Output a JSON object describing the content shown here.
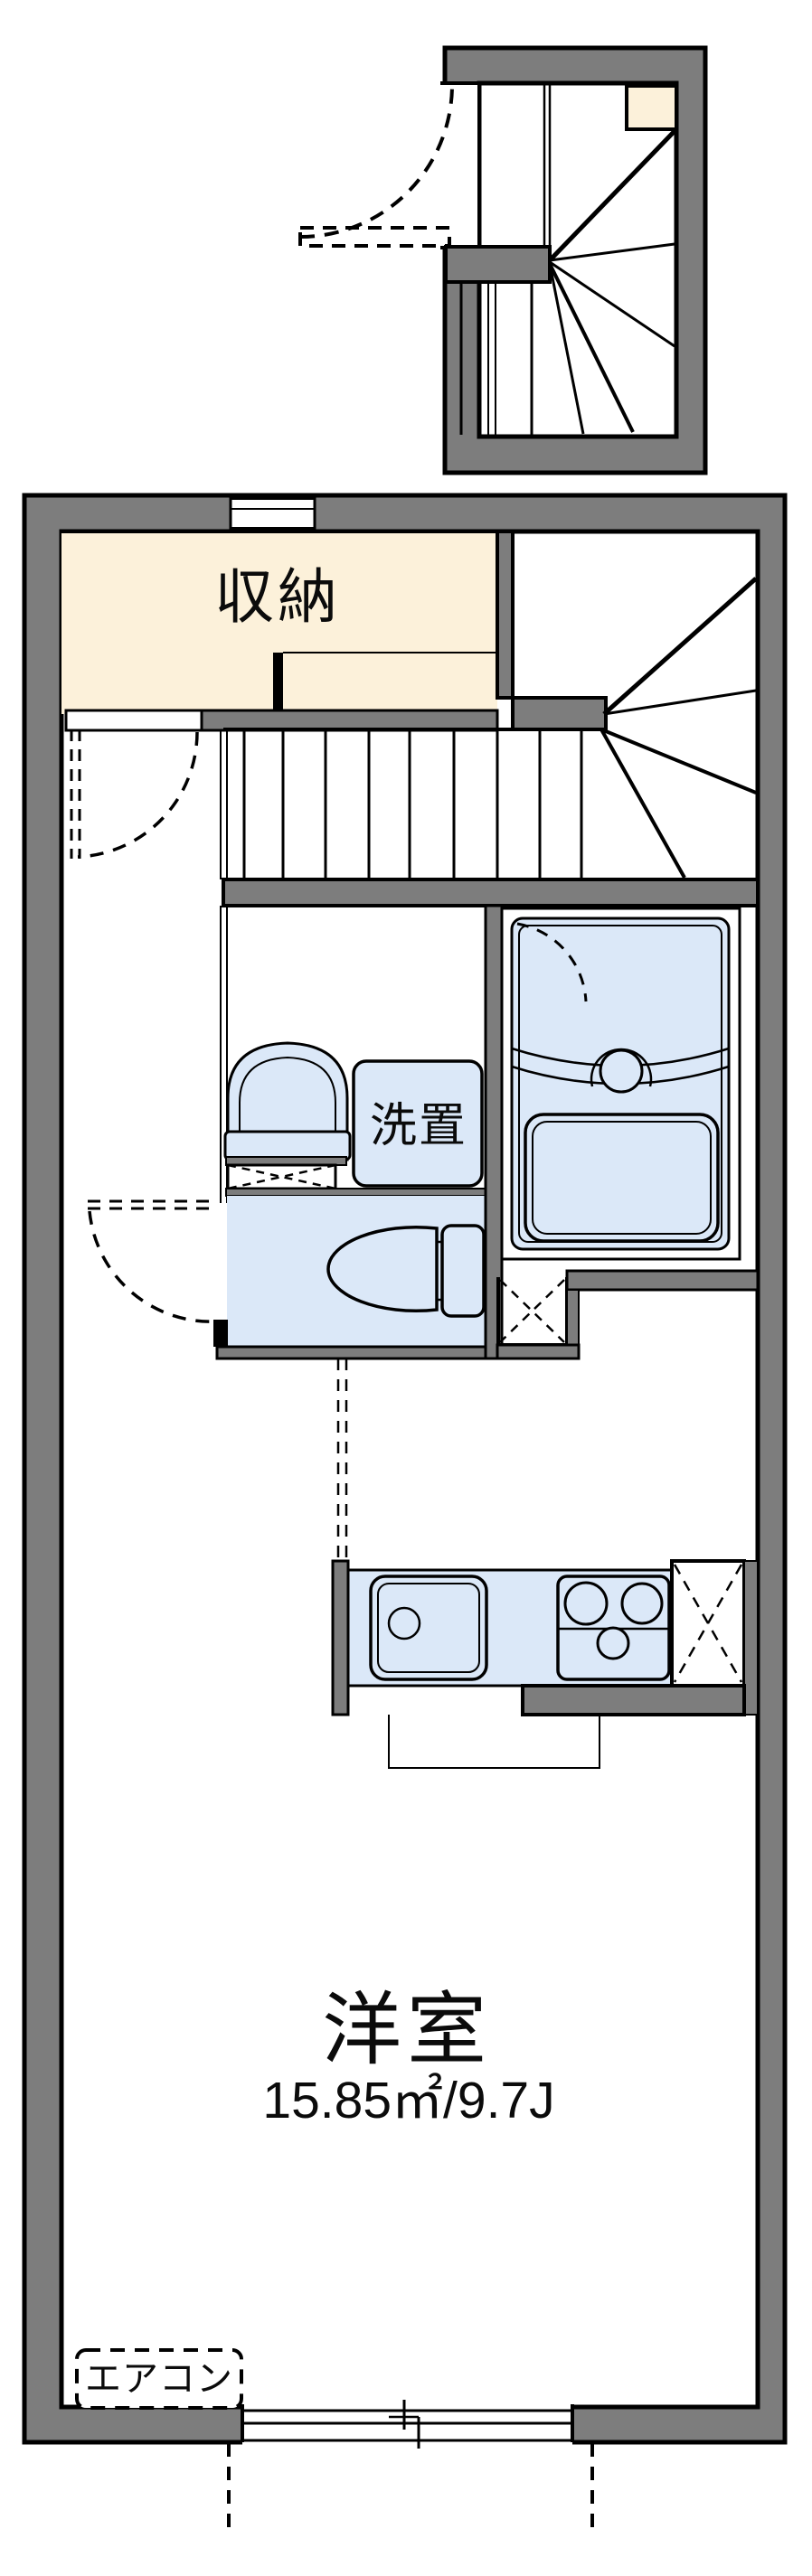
{
  "colors": {
    "wall_gray": "#7d7d7d",
    "outline_black": "#000000",
    "storage_cream": "#fcf1da",
    "fixture_blue": "#dbe8f8",
    "floor_white": "#ffffff"
  },
  "labels": {
    "storage": "収納",
    "washer_place": "洗置",
    "main_room": "洋室",
    "main_room_area": "15.85㎡/9.7J",
    "air_conditioner": "エアコン"
  }
}
